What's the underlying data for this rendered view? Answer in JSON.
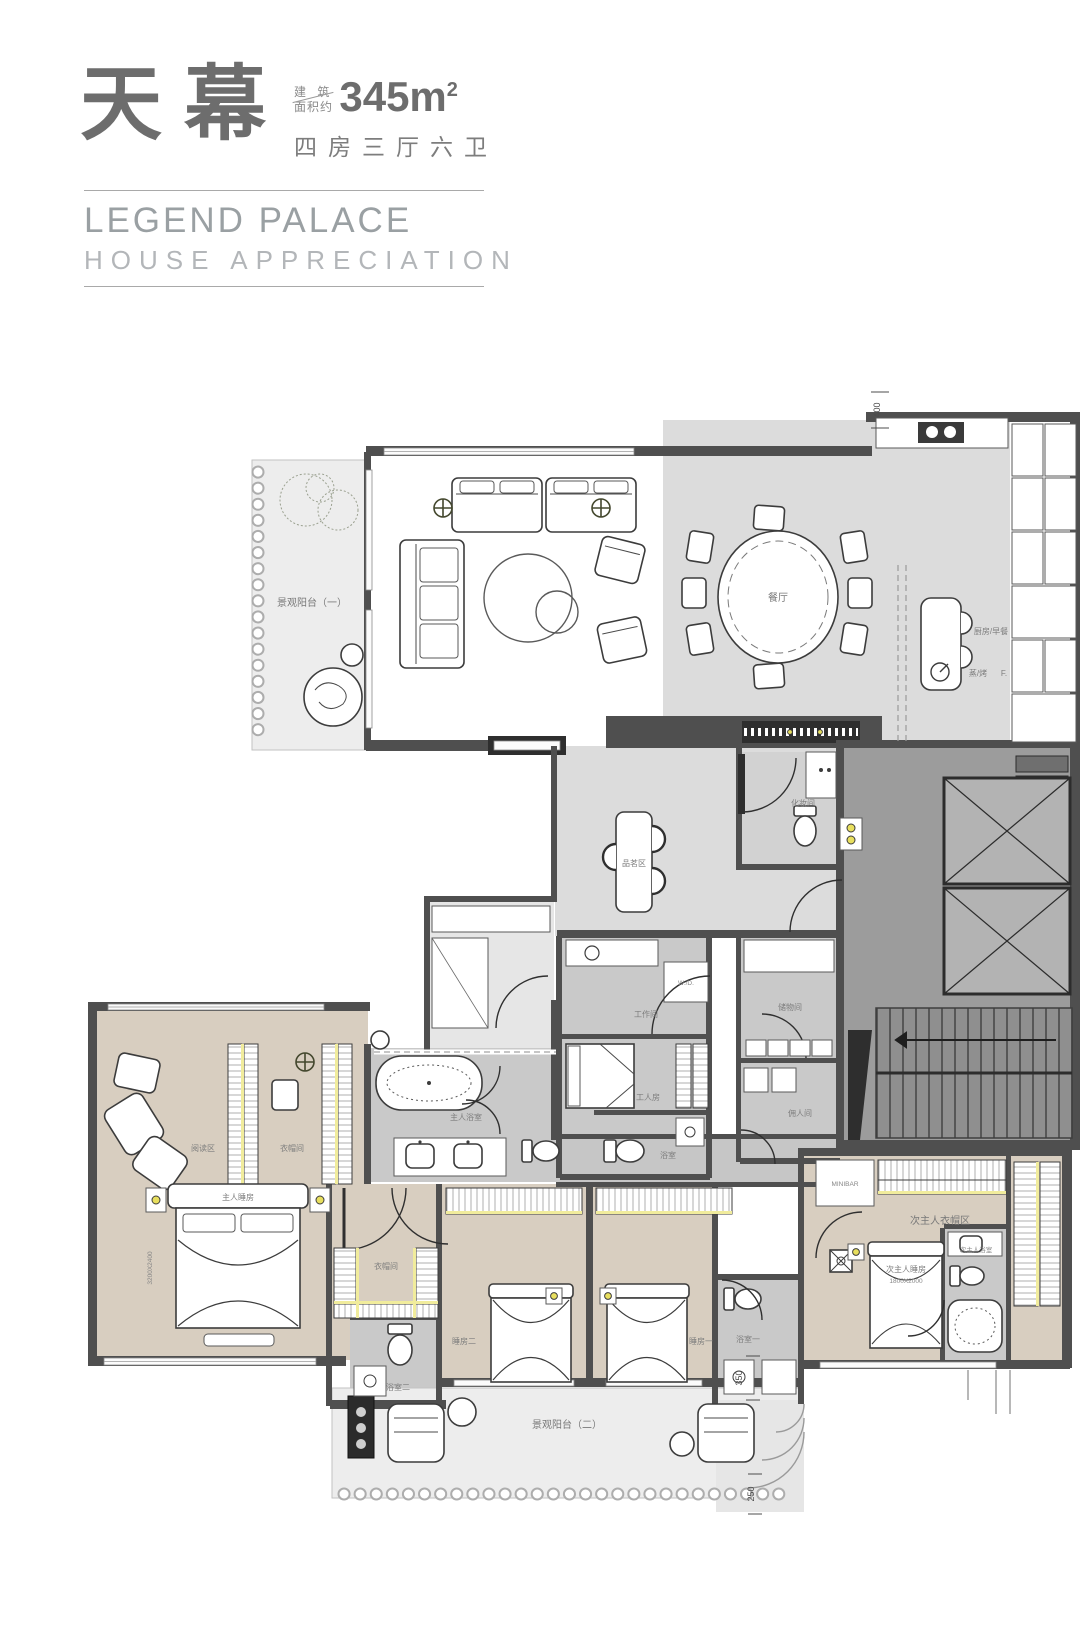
{
  "header": {
    "title": "天幕",
    "area_label_line1": "建 筑",
    "area_label_line2": "面积约",
    "area_value": "345m",
    "area_sup": "2",
    "layout_spec": "四房三厅六卫",
    "subtitle_line1": "LEGEND PALACE",
    "subtitle_line2": "HOUSE APPRECIATION"
  },
  "plan": {
    "rooms": {
      "balcony1": "景观阳台（一）",
      "dining": "餐厅",
      "kitchen": "厨房/早餐",
      "appliance_steam": "蒸/烤",
      "appliance_fridge": "F.",
      "tea_area": "品茗区",
      "powder_room": "化妆间",
      "storage": "储物间",
      "maid_room": "佣人间",
      "utility": "工作间",
      "washer_dryer": "W./D.",
      "staff_room": "工人房",
      "staff_bath": "浴室",
      "master_bath": "主人浴室",
      "reading_area": "阅读区",
      "master_closet": "衣帽间",
      "master_bedroom": "主人睡房",
      "master_bed_size": "3200X2400",
      "closet2": "衣帽间",
      "bath2": "浴室二",
      "bedroom2": "睡房二",
      "bedroom1": "睡房一",
      "bath1": "浴室一",
      "second_master_closet": "次主人衣帽区",
      "minibar": "MINIBAR",
      "second_master_bedroom": "次主人睡房",
      "second_master_bed_size": "1800X2000",
      "second_master_bath": "次主人浴室",
      "balcony2": "景观阳台（二）"
    },
    "dimensions": {
      "top_right": "400",
      "bottom_right_upper": "350",
      "bottom_right_lower": "250"
    }
  },
  "colors": {
    "wall": "#4f4f4f",
    "floor_gray": "#dcdcdc",
    "floor_beige": "#d8cec0",
    "floor_service": "#cbcbcb",
    "floor_balcony": "#ededed",
    "core_gray": "#9c9c9c",
    "accent_yellow": "#f1ec9c",
    "label_text": "#787878",
    "title_text": "#6d6d6d",
    "subtitle_text": "#a3a7aa"
  }
}
